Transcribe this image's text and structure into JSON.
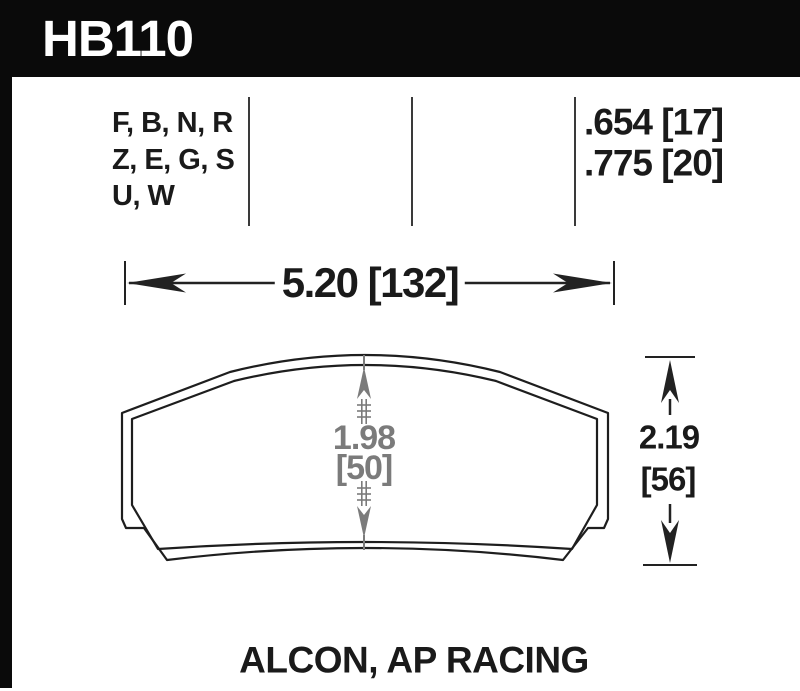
{
  "header": {
    "part_number": "HB110"
  },
  "compounds": {
    "lines": [
      "F, B, N, R",
      "Z, E, G, S",
      "U, W"
    ]
  },
  "pad_values": {
    "thickness_1": ".654 [17]",
    "thickness_2": ".775 [20]"
  },
  "dimensions": {
    "width": "5.20 [132]",
    "center_height_in": "1.98",
    "center_height_mm": "[50]",
    "overall_height_in": "2.19",
    "overall_height_mm": "[56]"
  },
  "footer": {
    "applications": "ALCON, AP RACING"
  },
  "colors": {
    "frame_black": "#0a0a0a",
    "line_black": "#222222",
    "dim_gray": "#7b7b7b",
    "background": "#ffffff"
  }
}
